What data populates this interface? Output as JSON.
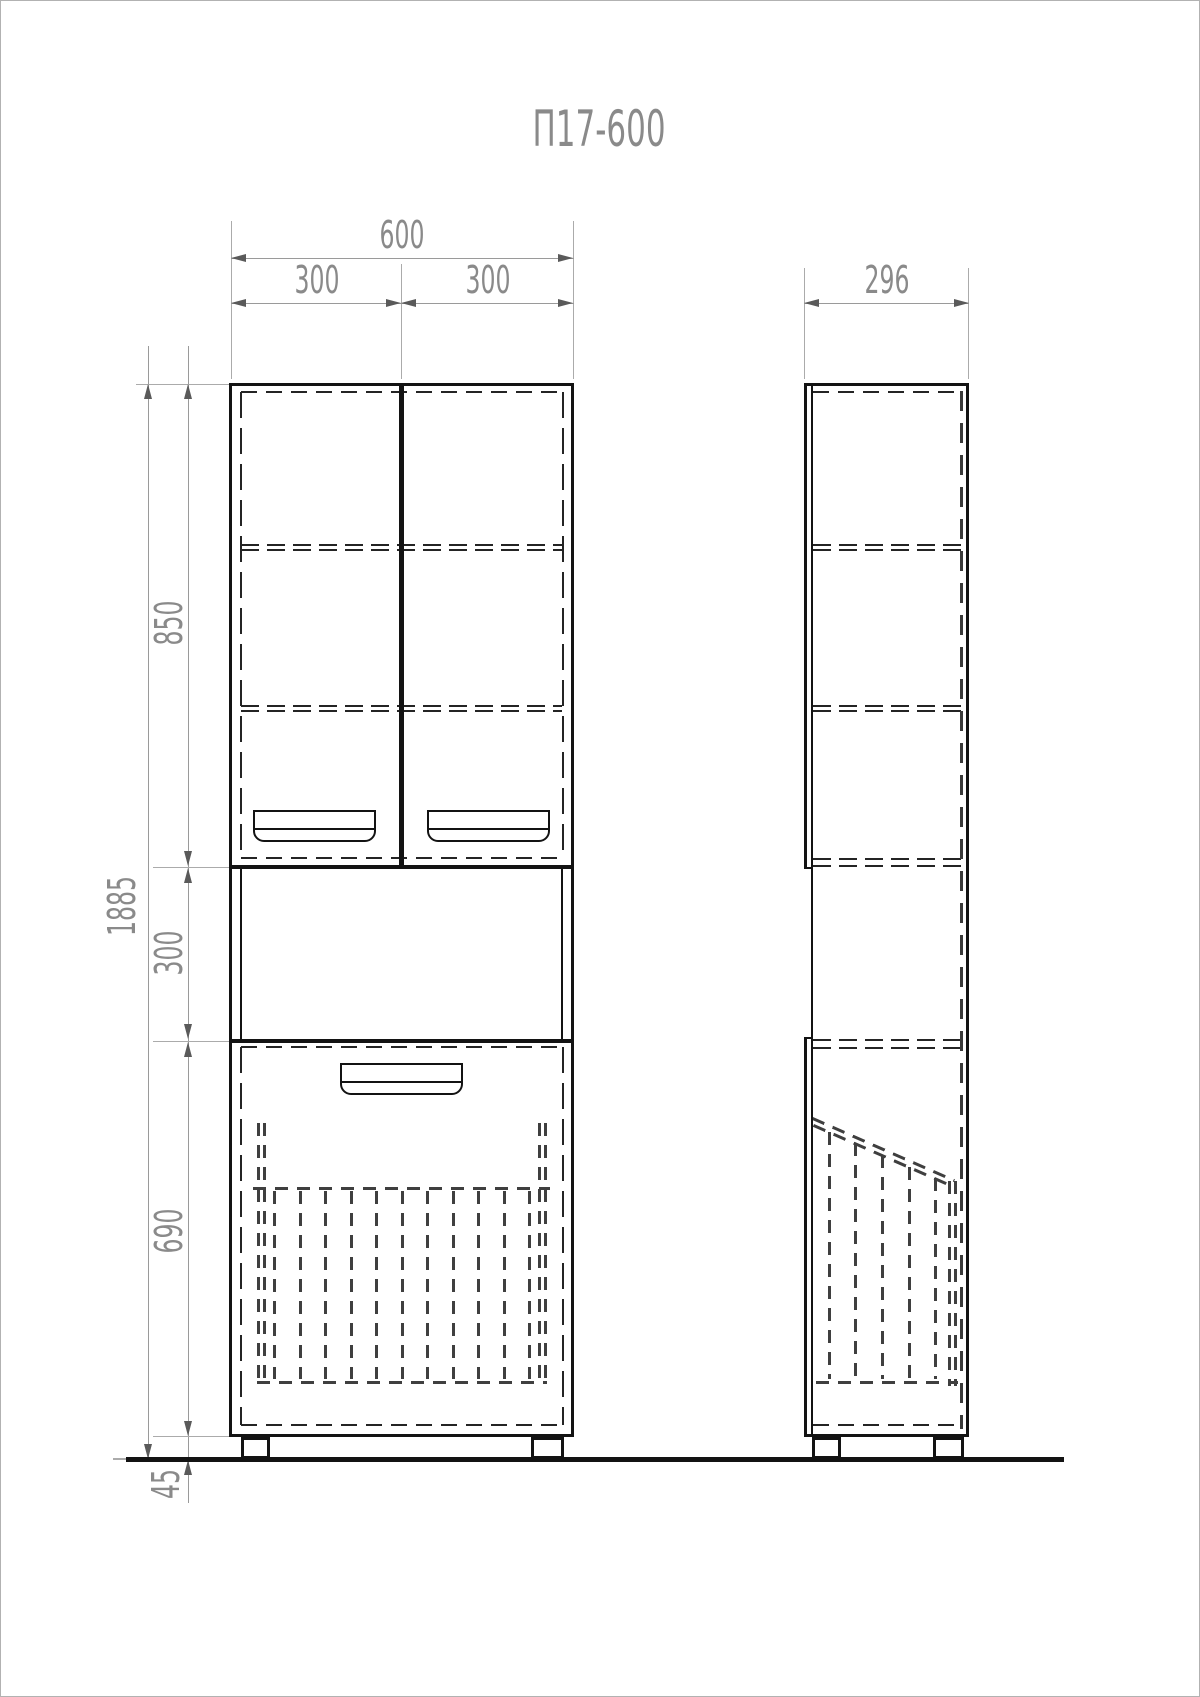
{
  "title": "П17-600",
  "colors": {
    "outline": "#131313",
    "hidden_edge": "#242424",
    "basket_dash": "#3f3f3f",
    "dimension_line": "#9a9a9a",
    "dimension_text": "#8a8a8a",
    "background": "#ffffff"
  },
  "front_view": {
    "dims": {
      "total_width": "600",
      "left_width": "300",
      "right_width": "300",
      "total_height": "1885",
      "upper_height": "850",
      "niche_height": "300",
      "lower_height": "690",
      "plinth_height": "45"
    }
  },
  "side_view": {
    "dims": {
      "depth": "296"
    }
  }
}
